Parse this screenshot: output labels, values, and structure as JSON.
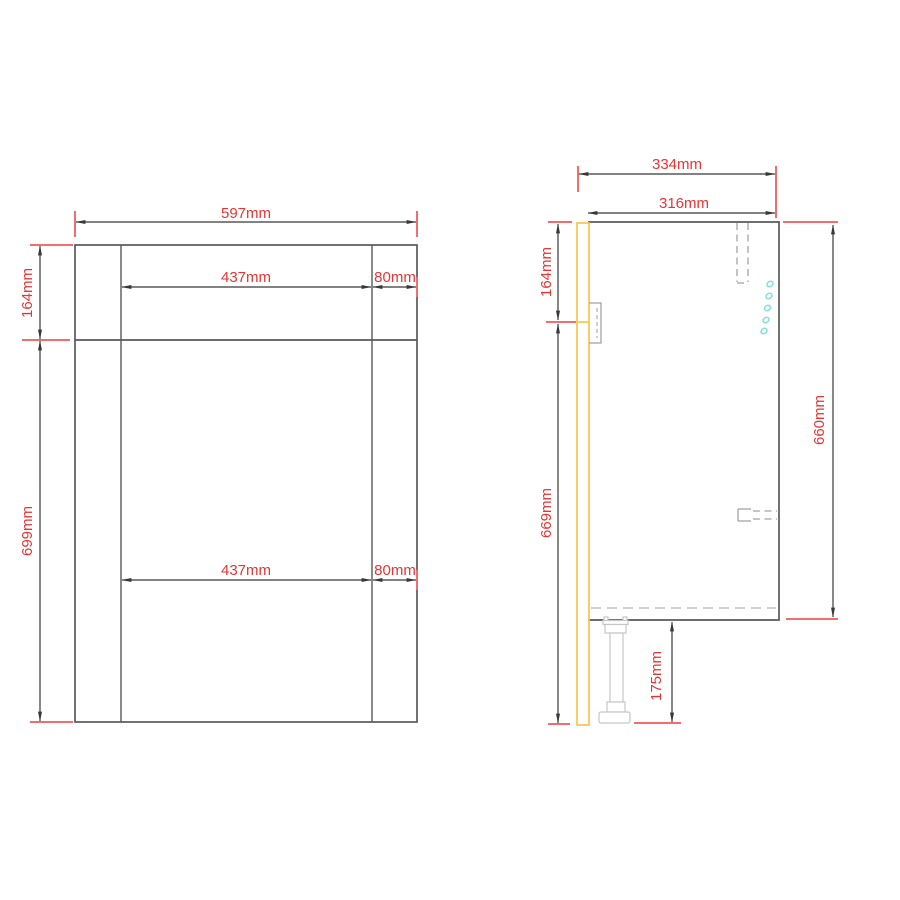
{
  "drawing_title": "base-cabinet-dimension-drawing",
  "colors": {
    "background": "#ffffff",
    "dimension_text": "#e53535",
    "extension_line": "#f26d6d",
    "dimension_line": "#383838",
    "cabinet_outline": "#595959",
    "door_panel": "#f8c44c",
    "hidden_detail": "#a3a3a3",
    "leg_outline": "#c6c6c6",
    "fitting_holes": "#84dfd8"
  },
  "front_view": {
    "overall_width": "597mm",
    "fascia_height": "164mm",
    "door_height": "699mm",
    "upper_clear_width": "437mm",
    "upper_edge_width": "80mm",
    "lower_clear_width": "437mm",
    "lower_edge_width": "80mm"
  },
  "side_view": {
    "overall_depth": "334mm",
    "carcass_depth": "316mm",
    "fascia_height": "164mm",
    "front_drop_height": "669mm",
    "carcass_height": "660mm",
    "leg_height": "175mm"
  }
}
